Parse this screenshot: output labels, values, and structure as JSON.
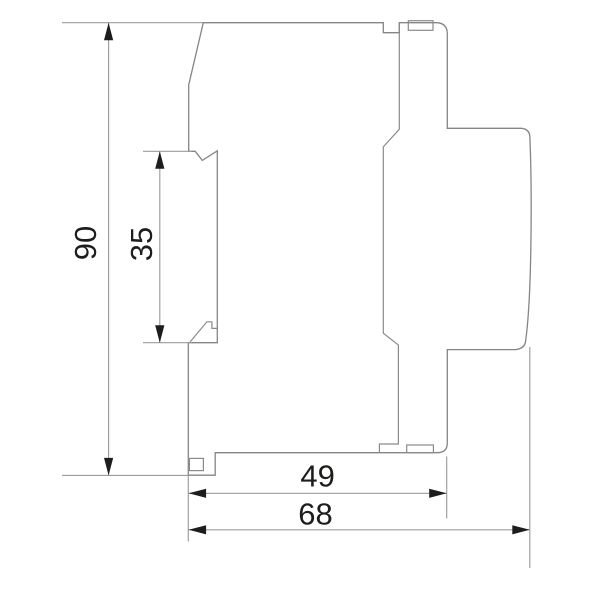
{
  "drawing": {
    "kind": "technical-side-profile",
    "dimensions": {
      "overall_height": {
        "label": "90"
      },
      "rail_recess": {
        "label": "35"
      },
      "body_depth": {
        "label": "49"
      },
      "overall_depth": {
        "label": "68"
      }
    },
    "colors": {
      "background": "#ffffff",
      "outline": "#858585",
      "dimension_lines": "#9c9c9c",
      "annotation": "#1d1d1b"
    }
  }
}
